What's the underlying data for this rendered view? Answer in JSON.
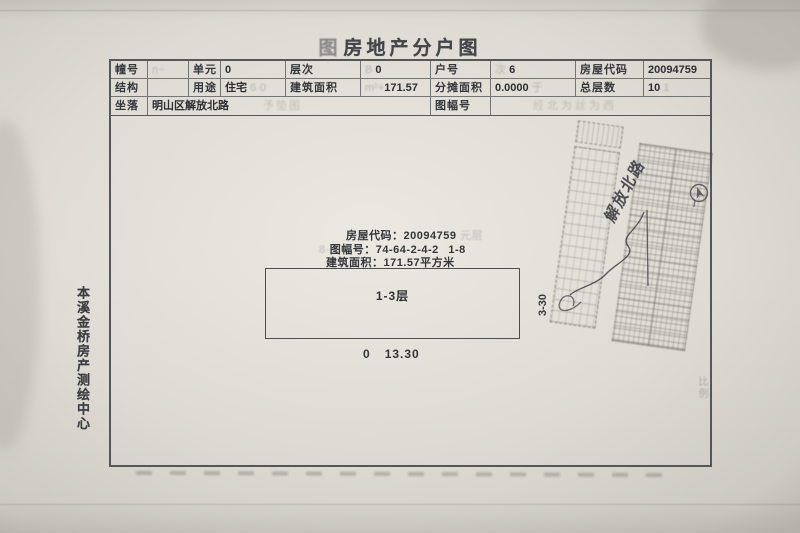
{
  "title": {
    "stamp_prefix": "图",
    "text": "房地产分户图"
  },
  "table": {
    "row1": {
      "label1": "幢号",
      "value1_artifact": "n~",
      "label2": "单元",
      "value2": "0",
      "label3": "层次",
      "value3_artifact": "B",
      "value3": "0",
      "label4": "户号",
      "value4_artifact": "次",
      "value4": "6",
      "label5": "房屋代码",
      "value5": "20094759"
    },
    "row2": {
      "label1": "结构",
      "value1": "",
      "label2": "用途",
      "value2": "住宅",
      "value2_artifact": "6·0",
      "label3": "建筑面积",
      "value3_artifact": "m²+",
      "value3": "171.57",
      "label4": "分摊面积",
      "value4": "0.0000",
      "value4_artifact": "于",
      "label5": "总层数",
      "value5": "10",
      "value5_artifact": "1"
    },
    "row3": {
      "label1": "坐落",
      "value1": "明山区解放北路",
      "value1_artifact": "予垫图",
      "label2": "图幅号",
      "value2_artifact": "经北为丝为西"
    }
  },
  "drawing": {
    "info": {
      "line1_label": "房屋代码",
      "line1_sep": "：",
      "line1_value": "20094759",
      "line1_artifact": "元层",
      "line2_artifact": "8-",
      "line2_label": "图幅号",
      "line2_sep": "：",
      "line2_value": "74-64-2-4-2",
      "line2_value2": "1-8",
      "line3_label": "建筑面积",
      "line3_sep": "：",
      "line3_value": "171.57平方米"
    },
    "unit_label": "1-3层",
    "dim_width_prefix": "0",
    "dim_width": "13.30",
    "dim_height": "3-30",
    "street_label": "解放北路",
    "scale_artifact": "比例"
  },
  "left_margin": {
    "agency": "本溪金桥房产测绘中心"
  },
  "icons": {
    "north_arrow": "▲"
  },
  "colors": {
    "paper": "#e2dfd8",
    "paper_edge": "#bdb9b2",
    "ink": "#3c3e43",
    "table_line": "#46484c",
    "stamp_faint": "#8d9099"
  }
}
